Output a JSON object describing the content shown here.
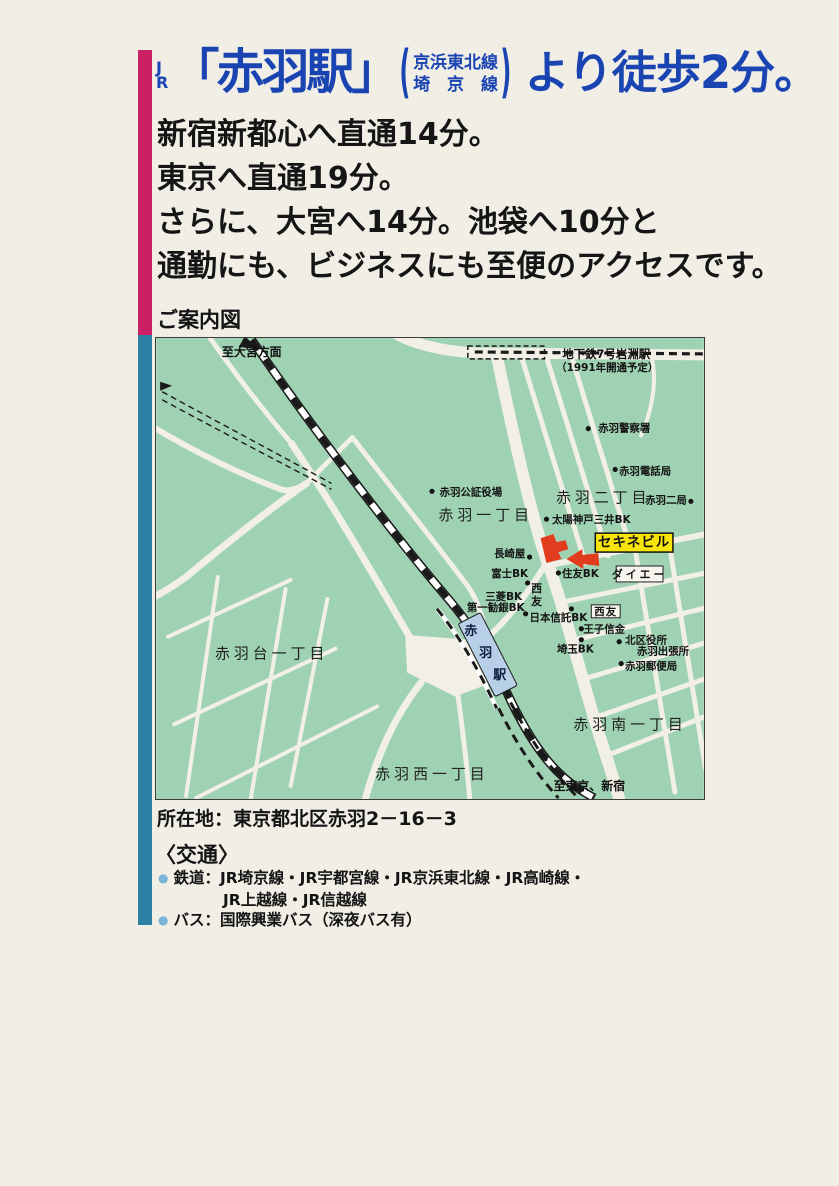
{
  "page_bg": "#f1eee6",
  "accent": {
    "magenta": "#cb2066",
    "teal": "#2d7fa4",
    "headline_blue": "#1a44b2"
  },
  "headline": {
    "jr_line1": "J",
    "jr_line2": "R",
    "station_quoted": "「赤羽駅」",
    "paren_open": "(",
    "paren_close": ")",
    "paren_line1": "京浜東北線",
    "paren_line2": "埼　京　線",
    "tail": "より徒歩2分。"
  },
  "body_lines": [
    "新宿新都心へ直通14分。",
    "東京へ直通19分。",
    "さらに、大宮へ14分。池袋へ10分と",
    "通勤にも、ビジネスにも至便のアクセスです。"
  ],
  "map_caption": "ご案内図",
  "address": "所在地：東京都北区赤羽2－16－3",
  "access": {
    "heading": "〈交通〉",
    "bullet_color": "#7ab5d8",
    "bullet_glyph": "●",
    "rows": [
      {
        "bullet": true,
        "indent": false,
        "text": "鉄道：JR埼京線・JR宇都宮線・JR京浜東北線・JR高崎線・"
      },
      {
        "bullet": false,
        "indent": true,
        "text": "JR上越線・JR信越線"
      },
      {
        "bullet": true,
        "indent": false,
        "text": "バス：国際興業バス（深夜バス有）"
      }
    ]
  },
  "map": {
    "bg": "#9fd2b3",
    "road_color": "#f1efe6",
    "rail_color": "#1a1a1a",
    "box_fill": "#f6f4ec",
    "dot_color": "#141414",
    "station": {
      "fill": "#b8cfe8"
    },
    "subway": {
      "label1": "地下鉄7号岩淵駅",
      "label2": "（1991年開通予定）"
    },
    "sekine": {
      "label": "セキネビル",
      "box_fill": "#f7e40a",
      "marker_red": "#e23c1e"
    },
    "labels": [
      {
        "type": "edge",
        "name": "map-label-to-omiya",
        "text": "至大宮方面",
        "x": 96,
        "y": 14
      },
      {
        "type": "edge",
        "name": "map-label-to-tokyo-shinjuku",
        "text": "至東京、新宿",
        "x": 435,
        "y": 450
      },
      {
        "type": "district",
        "name": "map-label-akabane-1chome",
        "text": "赤羽一丁目",
        "x": 331,
        "y": 178
      },
      {
        "type": "district",
        "name": "map-label-akabane-2chome",
        "text": "赤羽二丁目",
        "x": 449,
        "y": 160
      },
      {
        "type": "district",
        "name": "map-label-akabanedai-1chome",
        "text": "赤羽台一丁目",
        "x": 116,
        "y": 317
      },
      {
        "type": "district",
        "name": "map-label-akabane-minami-1chome",
        "text": "赤羽南一丁目",
        "x": 476,
        "y": 388
      },
      {
        "type": "district",
        "name": "map-label-akabane-nishi-1chome",
        "text": "赤羽西一丁目",
        "x": 277,
        "y": 438
      },
      {
        "type": "poi",
        "name": "map-label-akabane-police",
        "text": "赤羽警察署",
        "x": 470,
        "y": 91,
        "dot": [
          434,
          91
        ]
      },
      {
        "type": "poi",
        "name": "map-label-akabane-telephone",
        "text": "赤羽電話局",
        "x": 491,
        "y": 134,
        "dot": [
          461,
          132
        ]
      },
      {
        "type": "poi",
        "name": "map-label-notary-office",
        "text": "赤羽公証役場",
        "x": 316,
        "y": 155,
        "dot": [
          277,
          154
        ]
      },
      {
        "type": "poi",
        "name": "map-label-akabane-2-branch",
        "text": "赤羽二局",
        "x": 512,
        "y": 163,
        "dot": [
          537,
          164
        ]
      },
      {
        "type": "poi",
        "name": "map-label-taiyo-kobe-mitsui-bk",
        "text": "太陽神戸三井BK",
        "x": 437,
        "y": 183,
        "dot": [
          392,
          182
        ]
      },
      {
        "type": "poi",
        "name": "map-label-nagasakiya",
        "text": "長崎屋",
        "x": 355,
        "y": 217,
        "dot": [
          375,
          220
        ]
      },
      {
        "type": "poi",
        "name": "map-label-fuji-bk",
        "text": "富士BK",
        "x": 355,
        "y": 237,
        "dot": [
          373,
          246
        ]
      },
      {
        "type": "poi",
        "name": "map-label-sumitomo-bk",
        "text": "住友BK",
        "x": 426,
        "y": 237,
        "dot": [
          404,
          236
        ]
      },
      {
        "type": "poi",
        "name": "map-label-mitsubishi-bk",
        "text": "三菱BK",
        "x": 349,
        "y": 260
      },
      {
        "type": "poi",
        "name": "map-label-daiichi-kangin-bk",
        "text": "第一勧銀BK",
        "x": 341,
        "y": 271,
        "dot": [
          371,
          277
        ]
      },
      {
        "type": "poi",
        "name": "map-label-nihon-shintaku-bk",
        "text": "日本信託BK",
        "x": 404,
        "y": 281,
        "dot": [
          417,
          272
        ]
      },
      {
        "type": "poi",
        "name": "map-label-oji-shinkin",
        "text": "王子信金",
        "x": 450,
        "y": 293,
        "dot": [
          427,
          292
        ]
      },
      {
        "type": "poi",
        "name": "map-label-saitama-bk",
        "text": "埼玉BK",
        "x": 421,
        "y": 313,
        "dot": [
          427,
          303
        ]
      },
      {
        "type": "poi",
        "name": "map-label-kita-ward-office",
        "text": "北区役所",
        "x": 492,
        "y": 304,
        "dot": [
          465,
          305
        ]
      },
      {
        "type": "poi",
        "name": "map-label-akabane-branch-office",
        "text": "赤羽出張所",
        "x": 509,
        "y": 315
      },
      {
        "type": "poi",
        "name": "map-label-akabane-post-office",
        "text": "赤羽郵便局",
        "x": 497,
        "y": 330,
        "dot": [
          467,
          327
        ]
      },
      {
        "type": "station",
        "name": "map-station-char-1",
        "text": "赤",
        "x": 316,
        "y": 295
      },
      {
        "type": "station",
        "name": "map-station-char-2",
        "text": "羽",
        "x": 331,
        "y": 317
      },
      {
        "type": "station",
        "name": "map-station-char-3",
        "text": "駅",
        "x": 345,
        "y": 339
      },
      {
        "type": "vtext",
        "name": "map-label-seiyu-west",
        "text": "西友",
        "x": 382,
        "y": 251
      }
    ],
    "boxes": [
      {
        "name": "map-daiei-box",
        "text": "ダイエー",
        "x": 462,
        "y": 229,
        "w": 47,
        "h": 16,
        "fs": 11,
        "ls": 3
      },
      {
        "name": "map-seiyu-south-box",
        "text": "西友",
        "x": 437,
        "y": 268,
        "w": 29,
        "h": 13,
        "fs": 10.5,
        "ls": 1
      }
    ]
  }
}
